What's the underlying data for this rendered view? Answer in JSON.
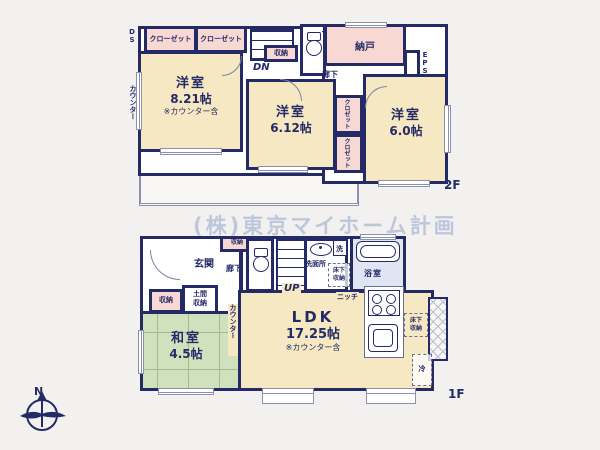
{
  "watermark": "(株)東京マイホーム計画",
  "compass": {
    "north_label": "N"
  },
  "colors": {
    "wall_navy": "#242a66",
    "room_beige": "#f6e8c2",
    "closet_pink": "#f7d8d3",
    "tatami_green": "#cfe1bd",
    "bath_blue": "#dfe5f2",
    "watermark_gray_blue": "#bdc7db"
  },
  "floor2": {
    "label": "2F",
    "closet1": "クローゼット",
    "closet2": "クローゼット",
    "room821": {
      "name": "洋室",
      "size": "8.21帖",
      "note": "※カウンター含"
    },
    "room612": {
      "name": "洋室",
      "size": "6.12帖"
    },
    "room60": {
      "name": "洋室",
      "size": "6.0帖"
    },
    "nando": "納戸",
    "shuno": "収納",
    "dn": "DN",
    "rouka": "廊下",
    "eps": "EPS",
    "ds": "DS",
    "counter_side": "カウンター",
    "counter_top": "カウンター",
    "closet_small1": "クロゼット",
    "closet_small2": "クロゼット",
    "balcony": "バルコニー"
  },
  "floor1": {
    "label": "1F",
    "genkan": "玄関",
    "rouka": "廊下",
    "shuno_hall": "収納",
    "up": "UP",
    "senmenjo": "洗面所",
    "sen": "洗",
    "yukashita_wash_l1": "床下",
    "yukashita_wash_l2": "収納",
    "yokushitsu": "浴室",
    "niche": "ニッチ",
    "doma_l1": "土間",
    "doma_l2": "収納",
    "shuno_washitsu": "収納",
    "washitsu": {
      "name": "和室",
      "size": "4.5帖"
    },
    "counter_side": "カウンター",
    "ldk": {
      "name": "LDK",
      "size": "17.25帖",
      "note": "※カウンター含"
    },
    "yukashita_kitchen_l1": "床下",
    "yukashita_kitchen_l2": "収納",
    "rei": "冷"
  }
}
